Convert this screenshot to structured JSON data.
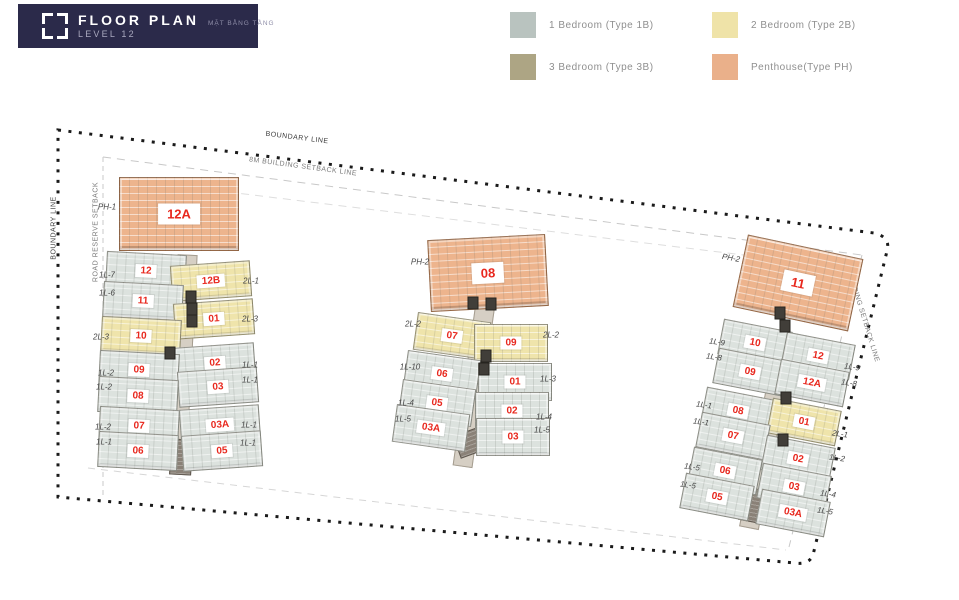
{
  "header": {
    "title": "FLOOR PLAN",
    "subtitle": "MẶT BẰNG TẦNG",
    "level": "LEVEL 12"
  },
  "legend": [
    {
      "type": "1B",
      "label": "1 Bedroom (Type 1B)"
    },
    {
      "type": "2B",
      "label": "2 Bedroom (Type 2B)"
    },
    {
      "type": "3B",
      "label": "3 Bedroom (Type 3B)"
    },
    {
      "type": "PH",
      "label": "Penthouse(Type PH)"
    }
  ],
  "colors": {
    "header_bg": "#2b2a4a",
    "unit_number": "#e8281e",
    "legend": {
      "1B": "#b9c3bf",
      "2B": "#efe3a8",
      "3B": "#ada584",
      "PH": "#eab08a"
    },
    "unit_fill": {
      "1B": "#dce2de",
      "2B": "#efe4ab",
      "3B": "#b3a98b",
      "PH": "#edb48d"
    }
  },
  "site_labels": [
    {
      "text": "BOUNDARY LINE",
      "x": 297,
      "y": 138,
      "rot": 7,
      "dark": true
    },
    {
      "text": "8M BUILDING SETBACK LINE",
      "x": 303,
      "y": 167,
      "rot": 7.5,
      "dark": false
    },
    {
      "text": "BOUNDARY LINE",
      "x": 54,
      "y": 228,
      "rot": -90,
      "dark": true
    },
    {
      "text": "ROAD RESERVE SETBACK",
      "x": 96,
      "y": 232,
      "rot": -90,
      "dark": false
    },
    {
      "text": "8M BUILDING SETBACK LINE",
      "x": 861,
      "y": 310,
      "rot": 73,
      "dark": false
    }
  ],
  "clusters": [
    {
      "id": "tower-a",
      "uw": 80,
      "uh": 36,
      "penthouse": {
        "num": "12A",
        "x": 179,
        "y": 214,
        "w": 120,
        "h": 74,
        "rot": 0
      },
      "corridor": {
        "x": 182,
        "y": 362,
        "w": 20,
        "h": 215,
        "rot": 3
      },
      "lobby": {
        "x": 181,
        "y": 457,
        "w": 22,
        "h": 36,
        "rot": 3
      },
      "cores": [
        {
          "x": 191,
          "y": 297
        },
        {
          "x": 192,
          "y": 309
        },
        {
          "x": 192,
          "y": 321
        },
        {
          "x": 170,
          "y": 353
        }
      ],
      "units": [
        {
          "num": "12",
          "type": "1B",
          "x": 146,
          "y": 271,
          "rot": 3
        },
        {
          "num": "12B",
          "type": "2B",
          "x": 211,
          "y": 281,
          "rot": -4
        },
        {
          "num": "11",
          "type": "1B",
          "x": 143,
          "y": 301,
          "rot": 3
        },
        {
          "num": "01",
          "type": "2B",
          "x": 214,
          "y": 319,
          "rot": -4
        },
        {
          "num": "10",
          "type": "2B",
          "x": 141,
          "y": 336,
          "rot": 3
        },
        {
          "num": "02",
          "type": "1B",
          "x": 215,
          "y": 363,
          "rot": -4
        },
        {
          "num": "09",
          "type": "1B",
          "x": 139,
          "y": 370,
          "rot": 3
        },
        {
          "num": "03",
          "type": "1B",
          "x": 218,
          "y": 387,
          "rot": -4
        },
        {
          "num": "08",
          "type": "1B",
          "x": 138,
          "y": 396,
          "rot": 3
        },
        {
          "num": "07",
          "type": "1B",
          "x": 139,
          "y": 426,
          "rot": 3
        },
        {
          "num": "03A",
          "type": "1B",
          "x": 220,
          "y": 425,
          "rot": -4
        },
        {
          "num": "06",
          "type": "1B",
          "x": 138,
          "y": 451,
          "rot": 3
        },
        {
          "num": "05",
          "type": "1B",
          "x": 222,
          "y": 451,
          "rot": -4
        }
      ],
      "labels": [
        {
          "text": "PH-1",
          "x": 107,
          "y": 207,
          "rot": 0
        },
        {
          "text": "1L-7",
          "x": 107,
          "y": 275,
          "rot": 0
        },
        {
          "text": "1L-6",
          "x": 107,
          "y": 293,
          "rot": 0
        },
        {
          "text": "2L-3",
          "x": 101,
          "y": 337,
          "rot": 0
        },
        {
          "text": "1L-2",
          "x": 106,
          "y": 373,
          "rot": 0
        },
        {
          "text": "1L-2",
          "x": 104,
          "y": 387,
          "rot": 0
        },
        {
          "text": "1L-2",
          "x": 103,
          "y": 427,
          "rot": 0
        },
        {
          "text": "1L-1",
          "x": 104,
          "y": 442,
          "rot": 0
        },
        {
          "text": "2L-1",
          "x": 251,
          "y": 281,
          "rot": 0
        },
        {
          "text": "2L-3",
          "x": 250,
          "y": 319,
          "rot": 0
        },
        {
          "text": "1L-1",
          "x": 250,
          "y": 365,
          "rot": 0
        },
        {
          "text": "1L-1",
          "x": 250,
          "y": 380,
          "rot": 0
        },
        {
          "text": "1L-1",
          "x": 249,
          "y": 425,
          "rot": 0
        },
        {
          "text": "1L-1",
          "x": 248,
          "y": 443,
          "rot": 0
        }
      ]
    },
    {
      "id": "tower-b",
      "uw": 74,
      "uh": 38,
      "penthouse": {
        "num": "08",
        "x": 488,
        "y": 273,
        "w": 118,
        "h": 72,
        "rot": -3
      },
      "corridor": {
        "x": 474,
        "y": 385,
        "w": 20,
        "h": 165,
        "rot": 8
      },
      "lobby": {
        "x": 469,
        "y": 443,
        "w": 26,
        "h": 24,
        "rot": -20
      },
      "cores": [
        {
          "x": 473,
          "y": 303
        },
        {
          "x": 491,
          "y": 304
        },
        {
          "x": 486,
          "y": 356
        },
        {
          "x": 484,
          "y": 369
        }
      ],
      "units": [
        {
          "num": "07",
          "type": "2B",
          "x": 452,
          "y": 336,
          "rot": 8
        },
        {
          "num": "09",
          "type": "2B",
          "x": 511,
          "y": 343,
          "rot": 0
        },
        {
          "num": "06",
          "type": "1B",
          "x": 442,
          "y": 374,
          "rot": 8
        },
        {
          "num": "01",
          "type": "1B",
          "x": 515,
          "y": 382,
          "rot": 0
        },
        {
          "num": "05",
          "type": "1B",
          "x": 437,
          "y": 403,
          "rot": 8
        },
        {
          "num": "02",
          "type": "1B",
          "x": 512,
          "y": 411,
          "rot": 0
        },
        {
          "num": "03A",
          "type": "1B",
          "x": 431,
          "y": 428,
          "rot": 8
        },
        {
          "num": "03",
          "type": "1B",
          "x": 513,
          "y": 437,
          "rot": 0
        }
      ],
      "labels": [
        {
          "text": "PH-2",
          "x": 420,
          "y": 262,
          "rot": 0
        },
        {
          "text": "2L-2",
          "x": 413,
          "y": 324,
          "rot": 0
        },
        {
          "text": "1L-10",
          "x": 410,
          "y": 367,
          "rot": 0
        },
        {
          "text": "1L-4",
          "x": 406,
          "y": 403,
          "rot": 0
        },
        {
          "text": "1L-5",
          "x": 403,
          "y": 419,
          "rot": 0
        },
        {
          "text": "2L-2",
          "x": 551,
          "y": 335,
          "rot": 0
        },
        {
          "text": "1L-3",
          "x": 548,
          "y": 379,
          "rot": 0
        },
        {
          "text": "1L-4",
          "x": 544,
          "y": 417,
          "rot": 0
        },
        {
          "text": "1L-5",
          "x": 542,
          "y": 430,
          "rot": 0
        }
      ]
    },
    {
      "id": "tower-c",
      "uw": 70,
      "uh": 36,
      "penthouse": {
        "num": "11",
        "x": 798,
        "y": 283,
        "w": 118,
        "h": 74,
        "rot": 12
      },
      "corridor": {
        "x": 768,
        "y": 430,
        "w": 20,
        "h": 200,
        "rot": 11
      },
      "lobby": {
        "x": 752,
        "y": 505,
        "w": 22,
        "h": 34,
        "rot": 11
      },
      "cores": [
        {
          "x": 780,
          "y": 313
        },
        {
          "x": 785,
          "y": 326
        },
        {
          "x": 786,
          "y": 398
        },
        {
          "x": 783,
          "y": 440
        }
      ],
      "units": [
        {
          "num": "10",
          "type": "1B",
          "x": 755,
          "y": 343,
          "rot": 11
        },
        {
          "num": "12",
          "type": "1B",
          "x": 818,
          "y": 356,
          "rot": 11
        },
        {
          "num": "09",
          "type": "1B",
          "x": 750,
          "y": 372,
          "rot": 11
        },
        {
          "num": "12A",
          "type": "1B",
          "x": 812,
          "y": 383,
          "rot": 11
        },
        {
          "num": "08",
          "type": "1B",
          "x": 738,
          "y": 411,
          "rot": 11
        },
        {
          "num": "01",
          "type": "2B",
          "x": 804,
          "y": 422,
          "rot": 11
        },
        {
          "num": "07",
          "type": "1B",
          "x": 733,
          "y": 436,
          "rot": 11
        },
        {
          "num": "02",
          "type": "1B",
          "x": 798,
          "y": 459,
          "rot": 11
        },
        {
          "num": "06",
          "type": "1B",
          "x": 725,
          "y": 471,
          "rot": 11
        },
        {
          "num": "03",
          "type": "1B",
          "x": 794,
          "y": 487,
          "rot": 11
        },
        {
          "num": "05",
          "type": "1B",
          "x": 717,
          "y": 497,
          "rot": 11
        },
        {
          "num": "03A",
          "type": "1B",
          "x": 793,
          "y": 513,
          "rot": 11
        }
      ],
      "labels": [
        {
          "text": "PH-2",
          "x": 731,
          "y": 258,
          "rot": 10
        },
        {
          "text": "1L-9",
          "x": 717,
          "y": 342,
          "rot": 8
        },
        {
          "text": "1L-8",
          "x": 714,
          "y": 357,
          "rot": 8
        },
        {
          "text": "1L-1",
          "x": 704,
          "y": 405,
          "rot": 8
        },
        {
          "text": "1L-1",
          "x": 701,
          "y": 422,
          "rot": 8
        },
        {
          "text": "1L-5",
          "x": 692,
          "y": 467,
          "rot": 8
        },
        {
          "text": "1L-5",
          "x": 688,
          "y": 485,
          "rot": 8
        },
        {
          "text": "1L-9",
          "x": 852,
          "y": 367,
          "rot": 8
        },
        {
          "text": "1L-8",
          "x": 849,
          "y": 383,
          "rot": 8
        },
        {
          "text": "2L-1",
          "x": 840,
          "y": 434,
          "rot": 8
        },
        {
          "text": "1L-2",
          "x": 837,
          "y": 458,
          "rot": 8
        },
        {
          "text": "1L-4",
          "x": 828,
          "y": 494,
          "rot": 8
        },
        {
          "text": "1L-5",
          "x": 825,
          "y": 511,
          "rot": 8
        }
      ]
    }
  ]
}
